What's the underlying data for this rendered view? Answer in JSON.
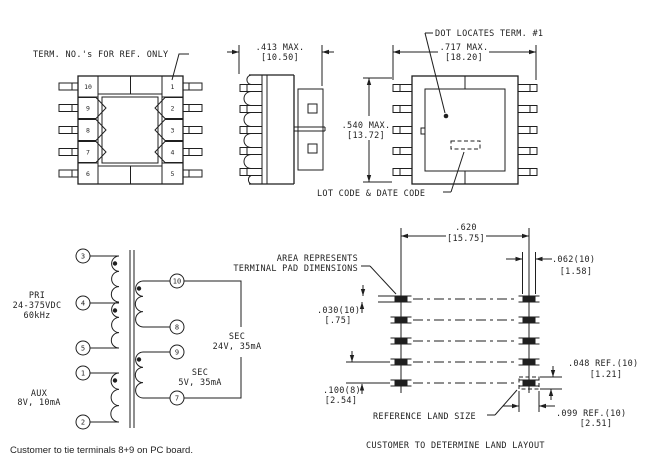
{
  "colors": {
    "ink": "#1f1f1f",
    "background": "#ffffff",
    "pad_fill": "#1f1f1f"
  },
  "top_view": {
    "label": "TERM. NO.'s FOR REF. ONLY",
    "left_terminals": [
      "10",
      "9",
      "8",
      "7",
      "6"
    ],
    "right_terminals": [
      "1",
      "2",
      "3",
      "4",
      "5"
    ]
  },
  "side_view": {
    "width_dim": {
      "inches": ".413 MAX.",
      "mm": "[10.50]"
    }
  },
  "bottom_view": {
    "dot_label": "DOT LOCATES TERM. #1",
    "lot_label": "LOT CODE & DATE CODE",
    "width_dim": {
      "inches": ".717 MAX.",
      "mm": "[18.20]"
    },
    "height_dim": {
      "inches": ".540 MAX.",
      "mm": "[13.72]"
    }
  },
  "schematic": {
    "primary": {
      "label_lines": [
        "PRI",
        "24-375VDC",
        "60kHz"
      ],
      "terminals": [
        "3",
        "4",
        "5"
      ]
    },
    "aux": {
      "label_lines": [
        "AUX",
        "8V, 10mA"
      ],
      "terminals": [
        "1",
        "2"
      ]
    },
    "sec1": {
      "label_lines": [
        "SEC",
        "24V, 35mA"
      ],
      "terminals": [
        "10",
        "8"
      ]
    },
    "sec2": {
      "label_lines": [
        "SEC",
        "5V, 35mA"
      ],
      "terminals": [
        "9",
        "7"
      ]
    },
    "note": "Customer to tie terminals 8+9 on PC board."
  },
  "land_pattern": {
    "area_label_line1": "AREA REPRESENTS",
    "area_label_line2": "TERMINAL PAD DIMENSIONS",
    "reference_label": "REFERENCE LAND SIZE",
    "note": "CUSTOMER TO DETERMINE LAND LAYOUT",
    "dims": {
      "pitch_x": {
        "inches": ".620",
        "mm": "[15.75]"
      },
      "pad_w": {
        "inches": ".062(10)",
        "mm": "[1.58]"
      },
      "pad_h": {
        "inches": ".030(10)",
        "mm": "[.75]"
      },
      "pitch_y": {
        "inches": ".100(8)",
        "mm": "[2.54]"
      },
      "land_h": {
        "inches": ".048 REF.(10)",
        "mm": "[1.21]"
      },
      "land_w": {
        "inches": ".099 REF.(10)",
        "mm": "[2.51]"
      }
    }
  }
}
